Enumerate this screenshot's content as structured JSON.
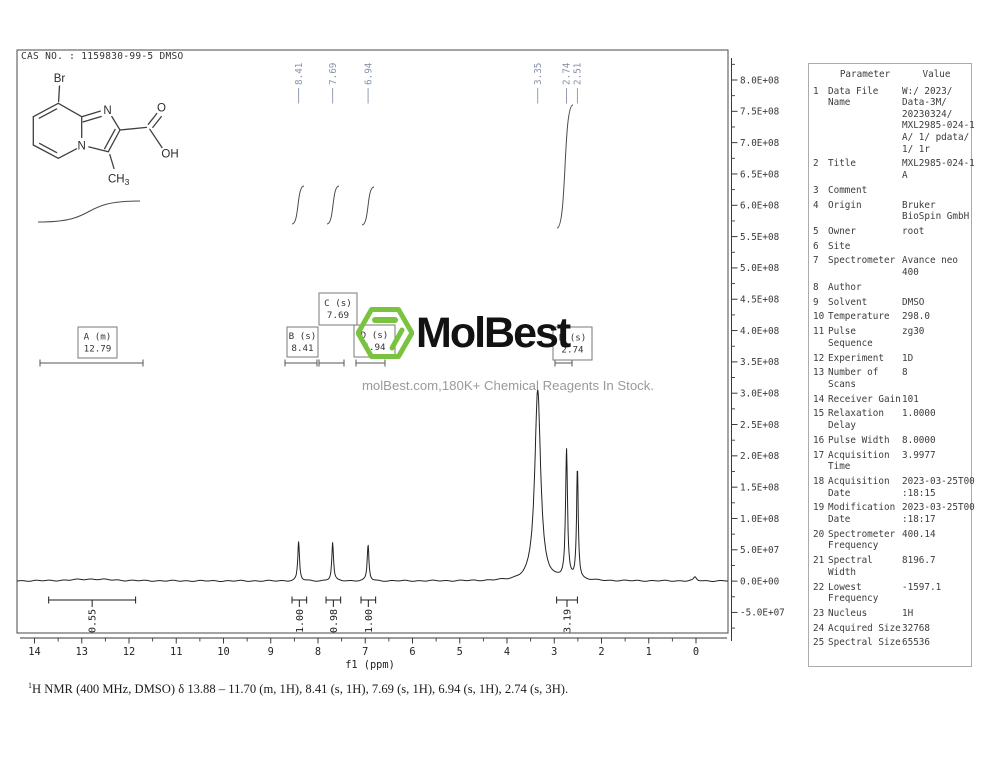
{
  "header": {
    "cas_line": "CAS NO. : 1159830-99-5 DMSO"
  },
  "colors": {
    "accent_green": "#79c33e",
    "peak_label": "#8892aa",
    "trace": "#222222"
  },
  "structure": {
    "atoms": {
      "br": "Br",
      "n_bridge": "N",
      "n_imidazole": "N",
      "o": "O",
      "oh": "OH",
      "ch": "CH",
      "ch_sub": "3"
    }
  },
  "watermark": {
    "logo_text": "MolBest",
    "tagline": "molBest.com,180K+ Chemical Reagents In Stock."
  },
  "caption": {
    "sup": "1",
    "text": "H NMR (400 MHz, DMSO) δ 13.88 – 11.70 (m, 1H), 8.41 (s, 1H), 7.69 (s, 1H), 6.94 (s, 1H), 2.74 (s, 3H)."
  },
  "parameter_table": {
    "headers": [
      "Parameter",
      "Value"
    ],
    "rows": [
      {
        "n": "1",
        "param": "Data File\nName",
        "value": "W:/ 2023/\nData-3M/\n20230324/\nMXL2985-024-1\nA/ 1/ pdata/\n1/ 1r"
      },
      {
        "n": "2",
        "param": "Title",
        "value": "MXL2985-024-1\nA"
      },
      {
        "n": "3",
        "param": "Comment",
        "value": ""
      },
      {
        "n": "4",
        "param": "Origin",
        "value": "Bruker\nBioSpin GmbH"
      },
      {
        "n": "5",
        "param": "Owner",
        "value": "root"
      },
      {
        "n": "6",
        "param": "Site",
        "value": ""
      },
      {
        "n": "7",
        "param": "Spectrometer",
        "value": "Avance neo\n400"
      },
      {
        "n": "8",
        "param": "Author",
        "value": ""
      },
      {
        "n": "9",
        "param": "Solvent",
        "value": "DMSO"
      },
      {
        "n": "10",
        "param": "Temperature",
        "value": "298.0"
      },
      {
        "n": "11",
        "param": "Pulse\nSequence",
        "value": "zg30"
      },
      {
        "n": "12",
        "param": "Experiment",
        "value": "1D"
      },
      {
        "n": "13",
        "param": "Number of\nScans",
        "value": "8"
      },
      {
        "n": "14",
        "param": "Receiver Gain",
        "value": "101"
      },
      {
        "n": "15",
        "param": "Relaxation\nDelay",
        "value": "1.0000"
      },
      {
        "n": "16",
        "param": "Pulse Width",
        "value": "8.0000"
      },
      {
        "n": "17",
        "param": "Acquisition\nTime",
        "value": "3.9977"
      },
      {
        "n": "18",
        "param": "Acquisition\nDate",
        "value": "2023-03-25T00\n:18:15"
      },
      {
        "n": "19",
        "param": "Modification\nDate",
        "value": "2023-03-25T00\n:18:17"
      },
      {
        "n": "20",
        "param": "Spectrometer\nFrequency",
        "value": "400.14"
      },
      {
        "n": "21",
        "param": "Spectral\nWidth",
        "value": "8196.7"
      },
      {
        "n": "22",
        "param": "Lowest\nFrequency",
        "value": "-1597.1"
      },
      {
        "n": "23",
        "param": "Nucleus",
        "value": "1H"
      },
      {
        "n": "24",
        "param": "Acquired Size",
        "value": "32768"
      },
      {
        "n": "25",
        "param": "Spectral Size",
        "value": "65536"
      }
    ]
  },
  "chart_data": {
    "type": "line",
    "title": "1H NMR spectrum",
    "xlabel": "f1 (ppm)",
    "x_ticks": [
      14,
      13,
      12,
      11,
      10,
      9,
      8,
      7,
      6,
      5,
      4,
      3,
      2,
      1,
      0
    ],
    "y_ticks": [
      "8.0E+08",
      "7.5E+08",
      "7.0E+08",
      "6.5E+08",
      "6.0E+08",
      "5.5E+08",
      "5.0E+08",
      "4.5E+08",
      "4.0E+08",
      "3.5E+08",
      "3.0E+08",
      "2.5E+08",
      "2.0E+08",
      "1.5E+08",
      "1.0E+08",
      "5.0E+07",
      "0.0E+00",
      "-5.0E+07"
    ],
    "xlim": [
      14.37,
      -0.68
    ],
    "ylim": [
      -83000000.0,
      850000000.0
    ],
    "peaks": [
      {
        "ppm": 12.79,
        "height": 3000000.0,
        "hwhm": 0.5
      },
      {
        "ppm": 8.41,
        "height": 62000000.0,
        "hwhm": 0.022
      },
      {
        "ppm": 7.69,
        "height": 61000000.0,
        "hwhm": 0.022
      },
      {
        "ppm": 6.94,
        "height": 57000000.0,
        "hwhm": 0.022
      },
      {
        "ppm": 3.35,
        "height": 305000000.0,
        "hwhm": 0.075
      },
      {
        "ppm": 2.74,
        "height": 206000000.0,
        "hwhm": 0.025
      },
      {
        "ppm": 2.51,
        "height": 177000000.0,
        "hwhm": 0.022
      },
      {
        "ppm": 0.02,
        "height": 6000000.0,
        "hwhm": 0.035
      }
    ],
    "peak_labels": [
      {
        "text": "8.41",
        "ppm": 8.41
      },
      {
        "text": "7.69",
        "ppm": 7.69
      },
      {
        "text": "6.94",
        "ppm": 6.94
      },
      {
        "text": "3.35",
        "ppm": 3.35
      },
      {
        "text": "2.74",
        "ppm": 2.74
      },
      {
        "text": "2.51",
        "ppm": 2.51
      }
    ],
    "integrals": [
      {
        "label": "0.55",
        "from_ppm": 13.7,
        "to_ppm": 11.86
      },
      {
        "label": "1.00",
        "from_ppm": 8.55,
        "to_ppm": 8.24
      },
      {
        "label": "0.98",
        "from_ppm": 7.83,
        "to_ppm": 7.52
      },
      {
        "label": "1.00",
        "from_ppm": 7.09,
        "to_ppm": 6.78
      },
      {
        "label": "3.19",
        "from_ppm": 2.95,
        "to_ppm": 2.51
      }
    ],
    "assignments": [
      {
        "key": "A",
        "label": "A (m)",
        "shift": "12.79"
      },
      {
        "key": "B",
        "label": "B (s)",
        "shift": "8.41"
      },
      {
        "key": "C",
        "label": "C (s)",
        "shift": "7.69"
      },
      {
        "key": "D",
        "label": "D (s)",
        "shift": "6.94"
      },
      {
        "key": "E",
        "label": "E (s)",
        "shift": "2.74"
      }
    ],
    "layout": {
      "plot": [
        17,
        50,
        711,
        583
      ],
      "x_axis_y": 638,
      "y_axis_x": 731.5,
      "x_at_14ppm": 34.5,
      "px_per_ppm": 47.25,
      "y_at_zero": 581,
      "counts_per_px": 1597000.0,
      "y_tick_step": 31.32,
      "boxes": {
        "A": [
          78,
          327,
          39,
          31
        ],
        "B": [
          287,
          327,
          31,
          30
        ],
        "C": [
          319,
          293,
          38,
          32
        ],
        "D": [
          354,
          325,
          41,
          32
        ],
        "E": [
          553,
          327,
          39,
          33
        ]
      },
      "regions": {
        "A": [
          40,
          143
        ],
        "B": [
          285,
          317
        ],
        "C": [
          319,
          344
        ],
        "D": [
          356,
          385
        ],
        "E": [
          555,
          572
        ]
      },
      "integral_curves": [
        [
          38,
          222,
          140,
          201
        ],
        [
          292,
          224,
          304,
          186
        ],
        [
          327,
          224,
          339,
          186
        ],
        [
          362,
          225,
          374,
          187
        ],
        [
          557,
          228,
          573,
          105
        ]
      ]
    }
  }
}
